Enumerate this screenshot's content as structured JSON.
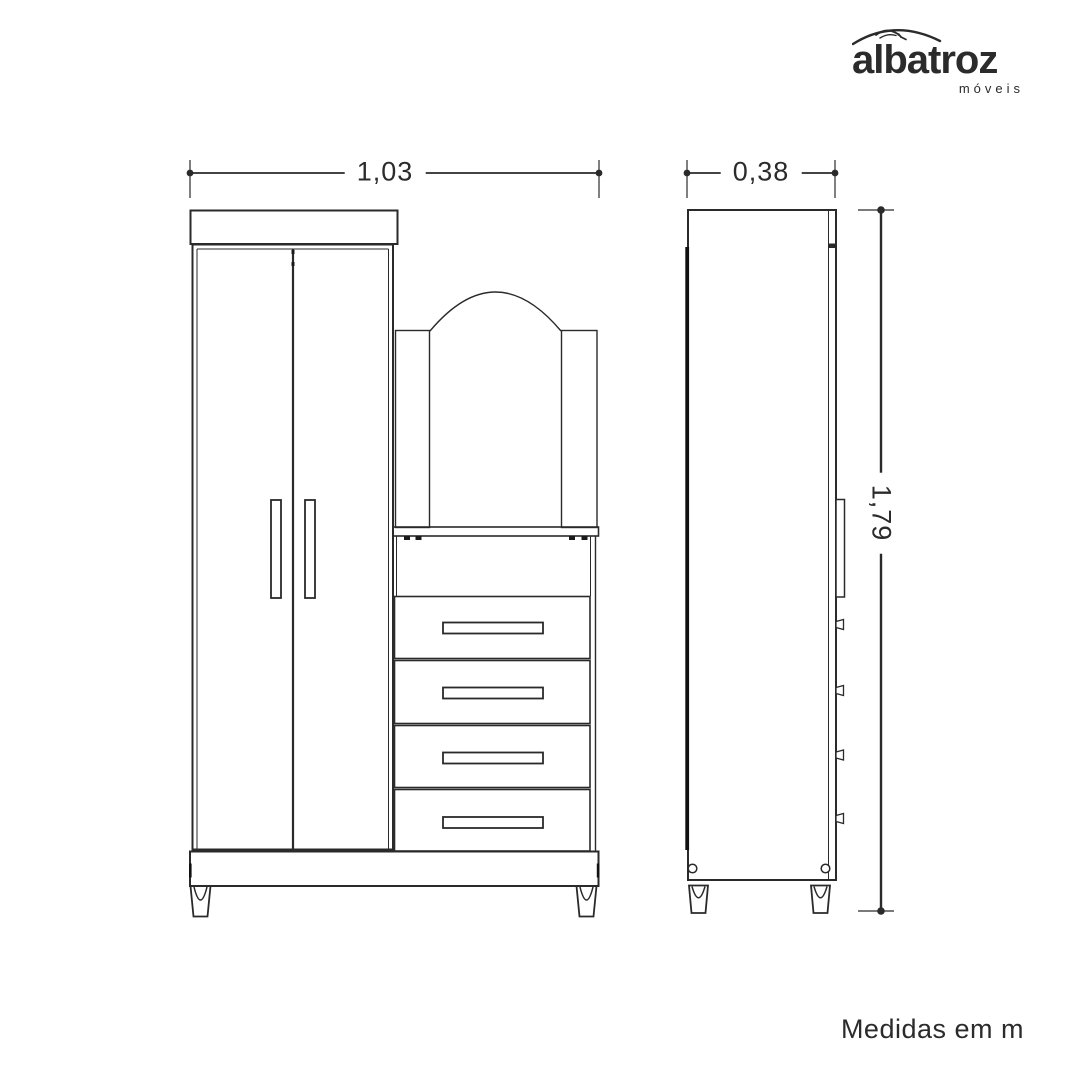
{
  "brand": {
    "name": "albatroz",
    "tagline": "móveis",
    "icon": "albatross-swoosh-icon"
  },
  "views": {
    "front": {
      "width_label": "1,03"
    },
    "side": {
      "depth_label": "0,38",
      "height_label": "1,79"
    }
  },
  "footnote": "Medidas em m",
  "units": "m",
  "furniture": {
    "description": "wardrobe with two doors, arched mirror and four drawers",
    "width_m": 1.03,
    "depth_m": 0.38,
    "height_m": 1.79
  },
  "colors": {
    "line": "#2a2a2a",
    "text": "#2b2b2b",
    "background": "#ffffff"
  }
}
